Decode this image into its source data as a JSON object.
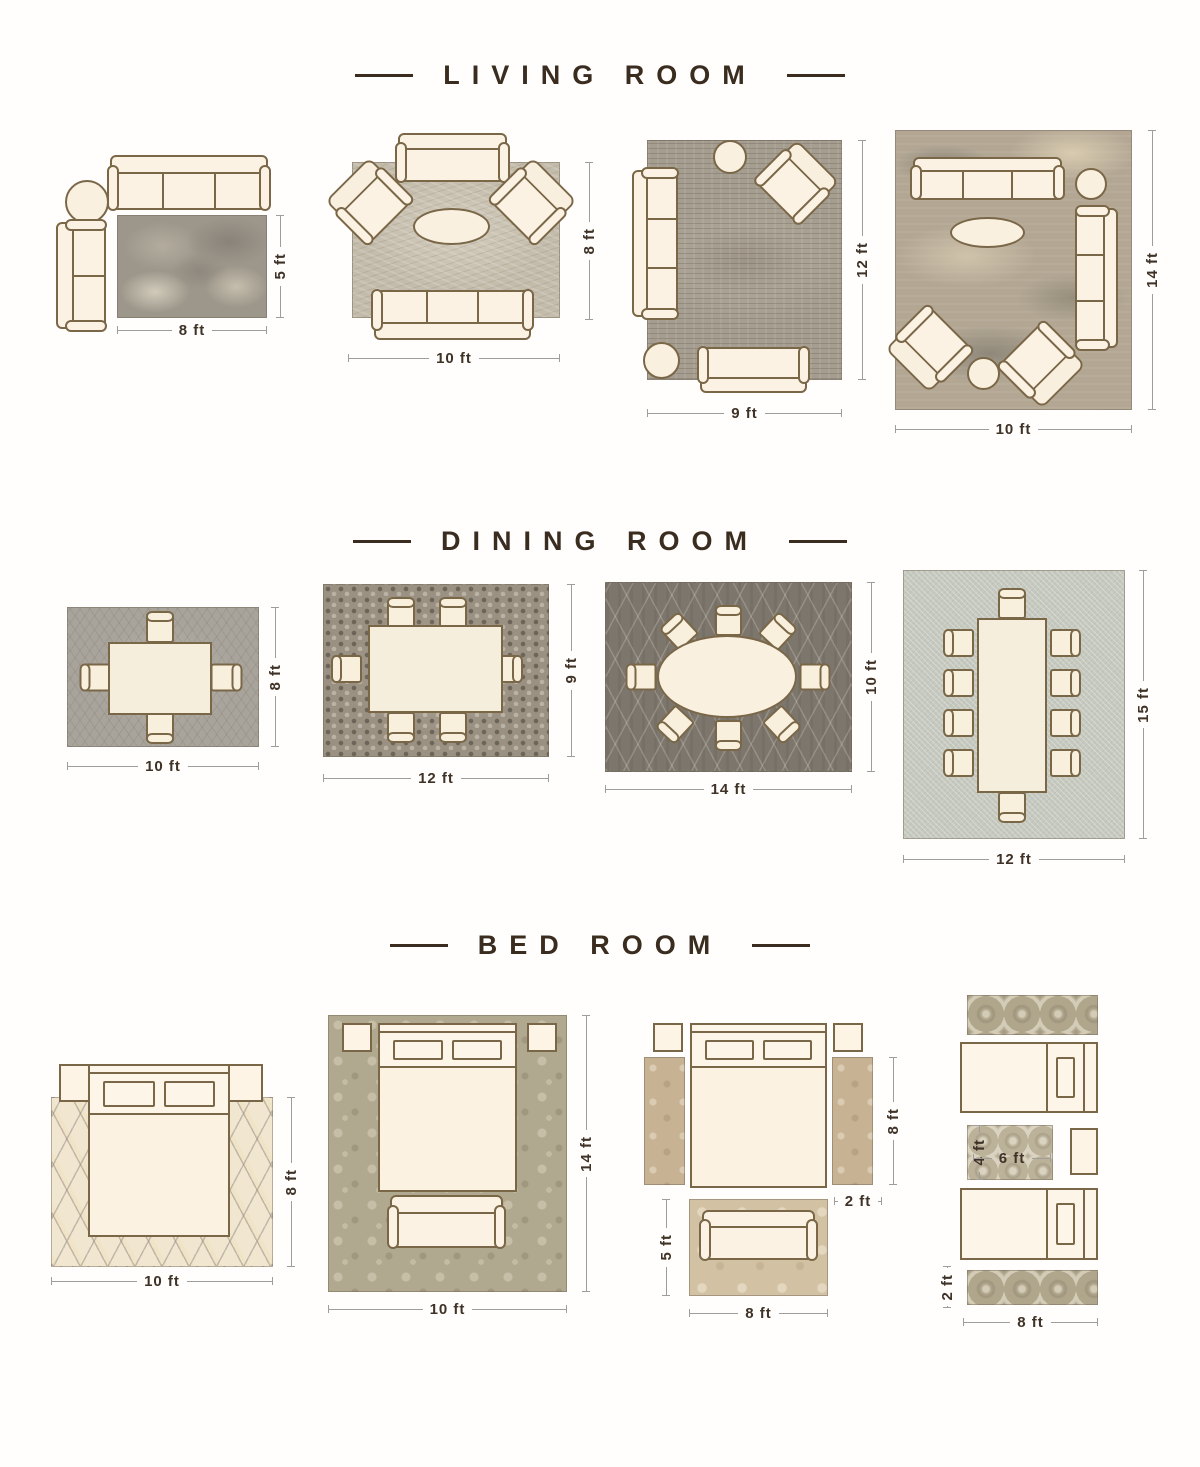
{
  "colors": {
    "title_text": "#3a2d20",
    "dimension_text": "#3f3227",
    "furniture_fill": "#fbf2e3",
    "furniture_outline": "#7a6748"
  },
  "living": {
    "title": "LIVING ROOM",
    "layouts": [
      {
        "width": "8 ft",
        "height": "5 ft"
      },
      {
        "width": "10 ft",
        "height": "8 ft"
      },
      {
        "width": "9 ft",
        "height": "12 ft"
      },
      {
        "width": "10 ft",
        "height": "14 ft"
      }
    ]
  },
  "dining": {
    "title": "DINING ROOM",
    "layouts": [
      {
        "width": "10 ft",
        "height": "8 ft"
      },
      {
        "width": "12 ft",
        "height": "9 ft"
      },
      {
        "width": "14 ft",
        "height": "10 ft"
      },
      {
        "width": "12 ft",
        "height": "15 ft"
      }
    ]
  },
  "bedroom": {
    "title": "BED ROOM",
    "layouts": [
      {
        "width": "10 ft",
        "height": "8 ft"
      },
      {
        "width": "10 ft",
        "height": "14 ft"
      },
      {
        "runner_height": "8 ft",
        "runner_width": "2 ft",
        "foot_rug_height": "5 ft",
        "foot_rug_width": "8 ft"
      },
      {
        "center_rug_height": "4 ft",
        "center_rug_width": "6 ft",
        "runner_width": "2 ft",
        "bed_width": "8 ft"
      }
    ]
  }
}
